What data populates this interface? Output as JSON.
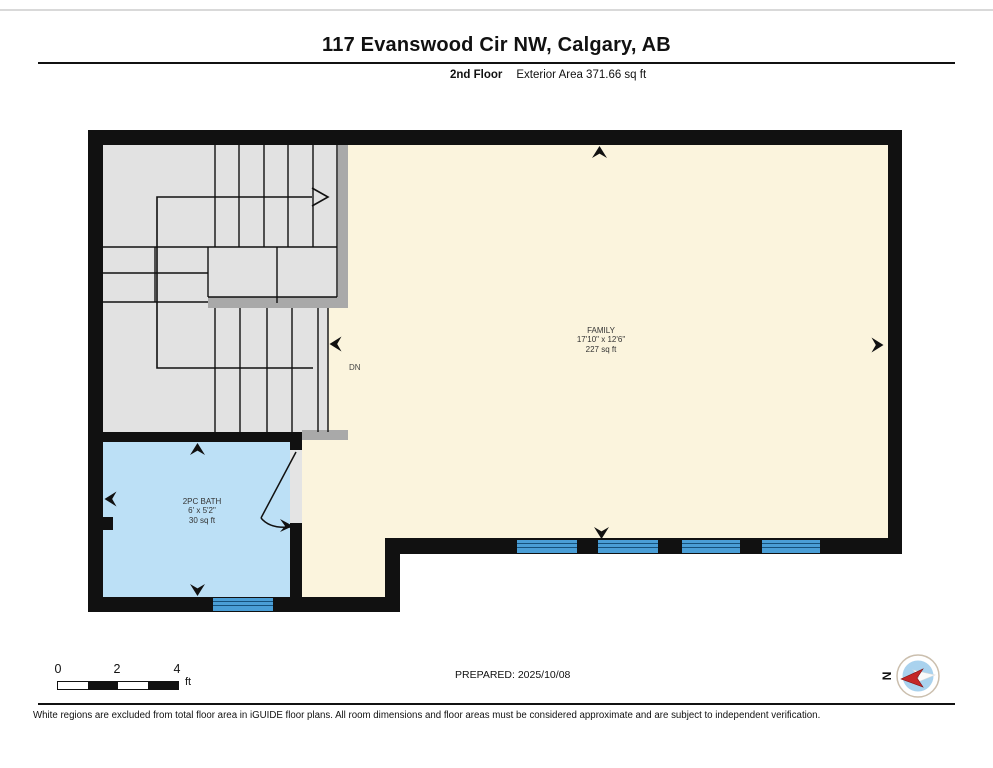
{
  "header": {
    "title": "117 Evanswood Cir NW, Calgary, AB",
    "floor_label": "2nd Floor",
    "area_label": "Exterior Area 371.66 sq ft"
  },
  "floorplan": {
    "rooms": [
      {
        "name": "FAMILY",
        "dimensions": "17'10\" x 12'6\"",
        "area": "227 sq ft"
      },
      {
        "name": "2PC BATH",
        "dimensions": "6' x 5'2\"",
        "area": "30 sq ft"
      }
    ],
    "stair_direction_label": "DN",
    "colors": {
      "wall": "#111111",
      "floor": "#FBF4DD",
      "stairs": "#E2E2E2",
      "railing": "#A9A9A9",
      "bath": "#BCE0F6",
      "window": "#4A9ED6",
      "door_opening": "#E4E4E4",
      "compass_red": "#C42727"
    }
  },
  "footer": {
    "scale_bar": {
      "ticks": [
        "0",
        "2",
        "4"
      ],
      "unit": "ft"
    },
    "prepared_label": "PREPARED: 2025/10/08",
    "compass_label": "N",
    "disclaimer": "White regions are excluded from total floor area in iGUIDE floor plans. All room dimensions and floor areas must be considered approximate and are subject to independent verification."
  }
}
